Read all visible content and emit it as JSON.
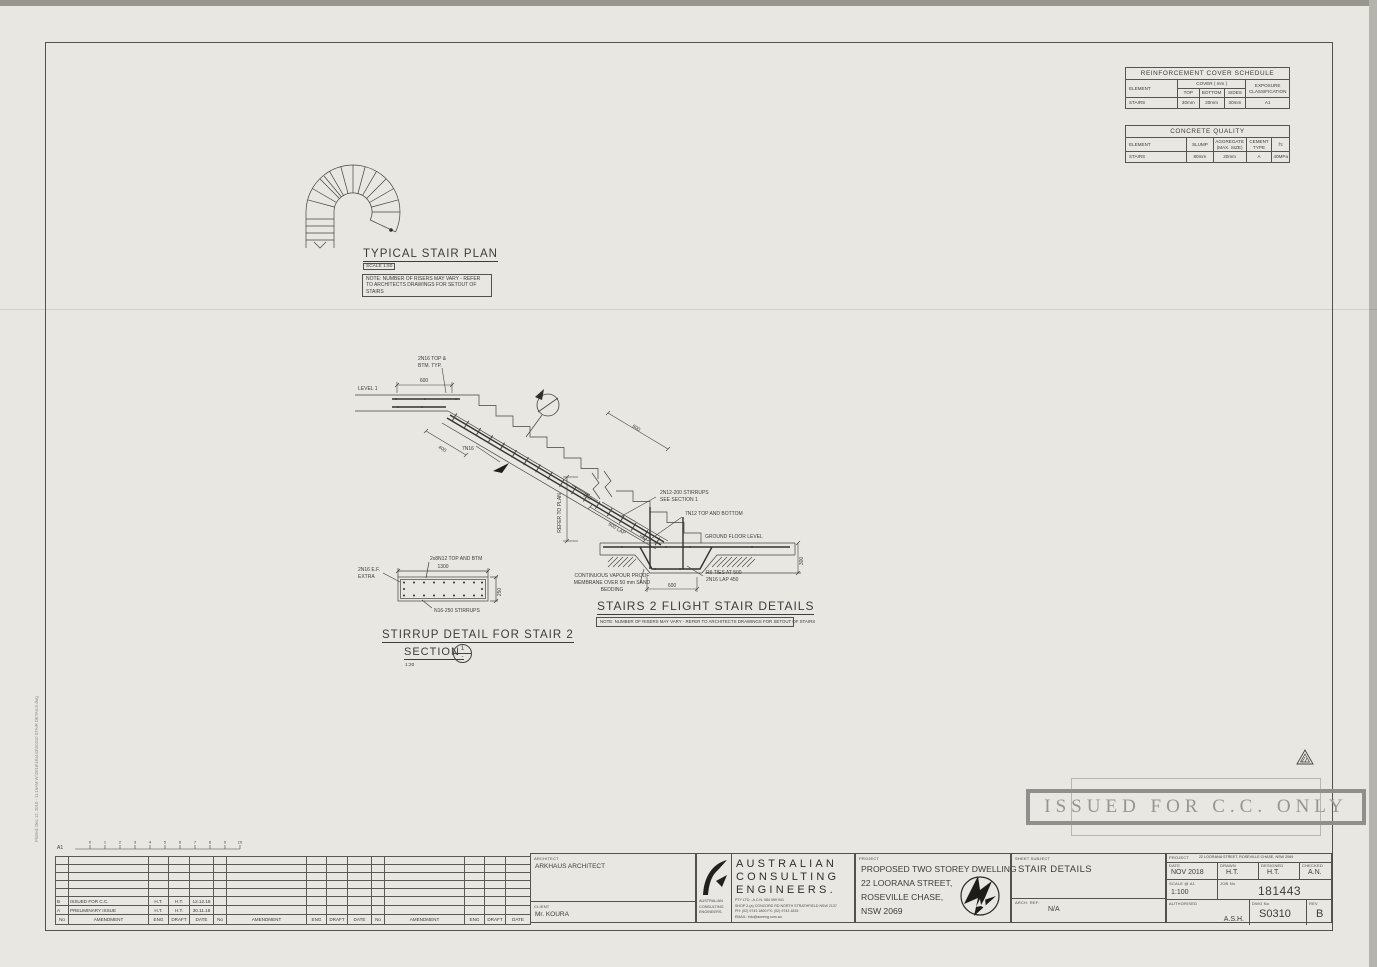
{
  "page": {
    "plot_stamp": "Plotted:  Dec 12, 2018 - 11:15AM   W:\\2018\\181443\\S0310 STAIR DETAILS.dwg"
  },
  "cover_schedule": {
    "title": "REINFORCEMENT COVER SCHEDULE",
    "col_element": "ELEMENT",
    "col_cover": "COVER ( mm )",
    "col_top": "TOP",
    "col_bottom": "BOTTOM",
    "col_sides": "SIDES",
    "col_exposure": "EXPOSURE CLASSIFICATION",
    "row": {
      "element": "STAIRS",
      "top": "30mm",
      "bottom": "30mm",
      "sides": "30mm",
      "exposure": "A1"
    }
  },
  "concrete_quality": {
    "title": "CONCRETE   QUALITY",
    "col_element": "ELEMENT",
    "col_slump": "SLUMP",
    "col_aggregate": "AGGREGATE (MAX. SIZE)",
    "col_cement": "CEMENT TYPE",
    "col_fc": "f'c",
    "row": {
      "element": "STAIRS",
      "slump": "80mm",
      "aggregate": "20mm",
      "cement": "A",
      "fc": "40MPa"
    }
  },
  "stair_plan": {
    "title": "TYPICAL STAIR PLAN",
    "scale_label": "SCALE 1:50",
    "note": "NOTE: NUMBER OF RISERS MAY VARY - REFER TO ARCHITECTS DRAWINGS FOR SETOUT OF STAIRS"
  },
  "flight_detail": {
    "title": "STAIRS 2 FLIGHT STAIR DETAILS",
    "note": "NOTE: NUMBER OF RISERS MAY VARY - REFER TO ARCHITECTS DRAWINGS FOR SETOUT OF STAIRS",
    "labels": {
      "level1": "LEVEL 1",
      "top_reo_1": "2N16 TOP &",
      "top_reo_2": "BTM. TYP.",
      "bars": "7N16",
      "stirrups_1": "2N12-200 STIRRUPS",
      "stirrups_2": "SEE SECTION 1",
      "bottom_reo": "7N12 TOP AND BOTTOM",
      "gfl": "GROUND FLOOR LEVEL",
      "refer": "REFER TO PLAN",
      "vapour_1": "CONTINUOUS VAPOUR PROOF",
      "vapour_2": "MEMBRANE OVER 50 mm SAND",
      "vapour_3": "BEDDING",
      "ties_1": "R6 TIES AT 500",
      "ties_2": "2N16 LAP 450"
    },
    "dims": {
      "top600": "600",
      "flight400": "400",
      "upper600": "600",
      "v250": "250",
      "lap600": "600 LAP",
      "base600": "600",
      "depth300": "300"
    }
  },
  "stirrup_detail": {
    "title": "STIRRUP DETAIL FOR STAIR 2",
    "section_label": "SECTION",
    "section_scale": "1:20",
    "bubble_top": "1",
    "bubble_bottom": "-",
    "labels": {
      "top": "2x8N12 TOP AND BTM",
      "ef_1": "2N16 E.F.",
      "ef_2": "EXTRA",
      "stirrups": "N16-250 STIRRUPS"
    },
    "dims": {
      "w": "1300",
      "h": "250"
    }
  },
  "stamp": {
    "text": "ISSUED FOR C.C. ONLY"
  },
  "revisions": {
    "headers": {
      "no": "No",
      "amendment": "AMENDMENT",
      "eng": "ENG",
      "draft": "DRAFT",
      "date": "DATE"
    },
    "rows": [
      {
        "no": "B",
        "amendment": "ISSUED FOR C.C.",
        "eng": "H.T.",
        "draft": "H.T.",
        "date": "12.12.18"
      },
      {
        "no": "A",
        "amendment": "PRELIMINARY ISSUE",
        "eng": "H.T.",
        "draft": "H.T.",
        "date": "30.11.18"
      }
    ],
    "scale_bar": {
      "label": "A1",
      "ticks": [
        "0",
        "1",
        "2",
        "3",
        "4",
        "5",
        "6",
        "7",
        "8",
        "9",
        "10"
      ]
    }
  },
  "titleblock": {
    "architect_label": "ARCHITECT",
    "architect": "ARKHAUS ARCHITECT",
    "client_label": "CLIENT",
    "client": "Mr. KOURA",
    "firm": {
      "name_1": "AUSTRALIAN",
      "name_2": "CONSULTING",
      "name_3": "ENGINEERS.",
      "side_1": "AUSTRALIAN",
      "side_2": "CONSULTING",
      "side_3": "ENGINEERS.",
      "pty": "PTY LTD  -  A.C.N.  084 059 941",
      "addr": "SHOP 2-(a) CONCORD RD NORTH STRATHFIELD NSW 2137",
      "phone": "PH: (02) 9743 1800    FX: (02) 9743 1815",
      "email": "EMAIL: info@aceeng.com.au"
    },
    "project_label": "PROJECT",
    "project_1": "PROPOSED TWO STOREY DWELLING",
    "project_2": "22 LOORANA STREET,",
    "project_3": "ROSEVILLE CHASE,",
    "project_4": "NSW 2069",
    "sheet_subject_label": "SHEET SUBJECT",
    "sheet_subject": "STAIR DETAILS",
    "arch_ref_label": "ARCH. REF:",
    "arch_ref": "N/A",
    "project_ref_label": "PROJECT",
    "project_ref": "22 LOORANA STREET, ROSEVILLE CHASE, NSW 2069",
    "date_label": "DATE",
    "date": "NOV 2018",
    "drawn_label": "DRAWN",
    "drawn": "H.T.",
    "designed_label": "DESIGNED",
    "designed": "H.T.",
    "checked_label": "CHECKED",
    "checked": "A.N.",
    "scale_label": "SCALE @ A1",
    "scale": "1:100",
    "job_label": "JOB No",
    "job": "181443",
    "authorised_label": "AUTHORISED",
    "authorised": "A.S.H.",
    "dwg_label": "DWG No",
    "dwg": "S0310",
    "rev_label": "REV",
    "rev": "B"
  }
}
